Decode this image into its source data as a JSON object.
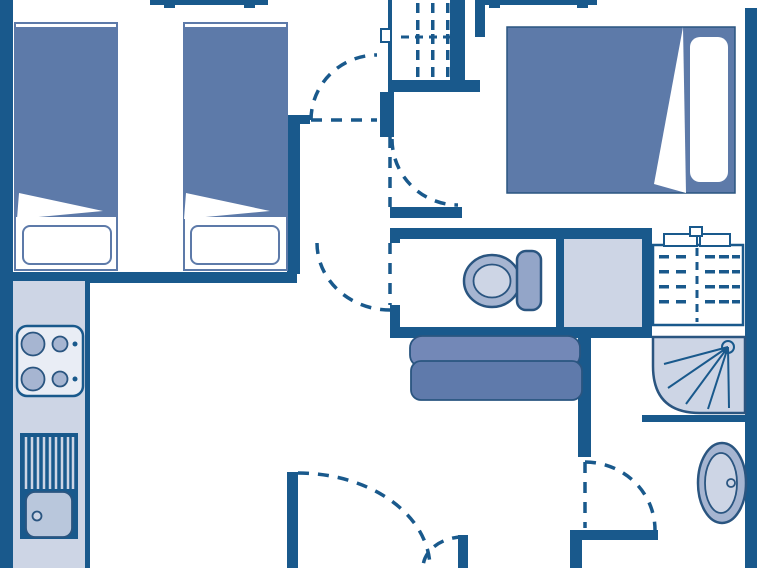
{
  "meta": {
    "type": "floor-plan",
    "width": 757,
    "height": 568
  },
  "colors": {
    "paper": "#ffffff",
    "wall": "#19598C",
    "outline": "#2A5580",
    "blanket": "#5D7AA9",
    "cushion_top": "#7388B7",
    "cushion_seat": "#5F7AAB",
    "light": "#CDD5E5",
    "medium": "#A6B5D1",
    "cistern": "#93A5C8",
    "basin": "#B9C7DC",
    "stove": "#E9EDF5"
  },
  "legend": {
    "plan": "Holiday home floor plan",
    "twin_bed_1": "Single bed",
    "twin_bed_2": "Single bed",
    "double_bed": "Double bed",
    "wardrobe_top": "Wardrobe with hangers",
    "wardrobe_right": "Wardrobe with hangers",
    "toilet": "Toilet",
    "sofa": "Sofa",
    "stove": "Cooktop with four burners",
    "kitchen_sink": "Kitchen sink with draining board",
    "shower": "Corner shower",
    "washbasin": "Washbasin",
    "window": "Window",
    "door": "Door swing",
    "entrance": "Double entrance door"
  }
}
